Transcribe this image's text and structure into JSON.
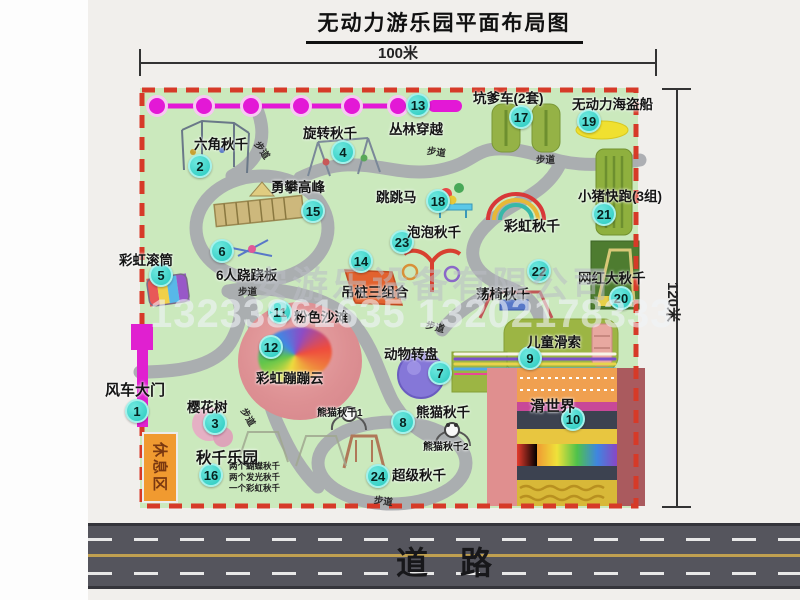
{
  "page": {
    "title": "无动力游乐园平面布局图",
    "dim_width_label": "100米",
    "dim_height_label": "120米",
    "road_label": "道路",
    "rest_area_label": "休息区"
  },
  "watermark": {
    "company": "安游乐设备有限公司",
    "phones": "13233861635 13202178333"
  },
  "colors": {
    "map_green": "#cbe9bd",
    "border_red": "#d63a28",
    "badge_teal": "#27c9be",
    "zipline_magenta": "#e318d6",
    "gate_magenta": "#e020d0",
    "rest_orange": "#f09a30",
    "path_gray": "#a9abb0",
    "road_gray": "#55555d"
  },
  "markers": [
    {
      "n": "1",
      "label": "风车大门",
      "lx": 105,
      "ly": 379,
      "bx": 137,
      "by": 411,
      "fs": 15
    },
    {
      "n": "2",
      "label": "六角秋千",
      "lx": 194,
      "ly": 133,
      "bx": 200,
      "by": 166
    },
    {
      "n": "3",
      "label": "樱花树",
      "lx": 187,
      "ly": 396,
      "bx": 215,
      "by": 423
    },
    {
      "n": "4",
      "label": "旋转秋千",
      "lx": 303,
      "ly": 122,
      "bx": 343,
      "by": 152
    },
    {
      "n": "5",
      "label": "彩虹滚筒",
      "lx": 119,
      "ly": 249,
      "bx": 161,
      "by": 275
    },
    {
      "n": "6",
      "label": "6人跷跷板",
      "lx": 216,
      "ly": 264,
      "bx": 222,
      "by": 251
    },
    {
      "n": "7",
      "label": "动物转盘",
      "lx": 384,
      "ly": 343,
      "bx": 440,
      "by": 373
    },
    {
      "n": "8",
      "label": "熊猫秋千",
      "lx": 416,
      "ly": 401,
      "bx": 403,
      "by": 422
    },
    {
      "n": "9",
      "label": "儿童滑索",
      "lx": 527,
      "ly": 331,
      "bx": 530,
      "by": 358
    },
    {
      "n": "10",
      "label": "滑世界",
      "lx": 530,
      "ly": 395,
      "bx": 573,
      "by": 419,
      "fs": 15
    },
    {
      "n": "11",
      "label": "粉色沙滩",
      "lx": 294,
      "ly": 306,
      "bx": 280,
      "by": 312
    },
    {
      "n": "12",
      "label": "彩虹蹦蹦云",
      "lx": 256,
      "ly": 367,
      "bx": 271,
      "by": 347
    },
    {
      "n": "13",
      "label": "丛林穿越",
      "lx": 389,
      "ly": 118,
      "bx": 418,
      "by": 105
    },
    {
      "n": "14",
      "label": "吊桩三组合",
      "lx": 341,
      "ly": 281,
      "bx": 361,
      "by": 261
    },
    {
      "n": "15",
      "label": "勇攀高峰",
      "lx": 271,
      "ly": 176,
      "bx": 313,
      "by": 211
    },
    {
      "n": "16",
      "label": "秋千乐园",
      "lx": 196,
      "ly": 446,
      "bx": 211,
      "by": 475,
      "fs": 15.5,
      "sub": [
        "两个蝴蝶秋千",
        "两个发光秋千",
        "一个彩虹秋千"
      ],
      "sx": 229,
      "sy": 461
    },
    {
      "n": "17",
      "label": "坑爹车(2套)",
      "lx": 473,
      "ly": 87,
      "bx": 521,
      "by": 117
    },
    {
      "n": "18",
      "label": "跳跳马",
      "lx": 376,
      "ly": 186,
      "bx": 438,
      "by": 201
    },
    {
      "n": "19",
      "label": "无动力海盗船",
      "lx": 572,
      "ly": 93,
      "bx": 589,
      "by": 121
    },
    {
      "n": "20",
      "label": "网红大秋千",
      "lx": 578,
      "ly": 267,
      "bx": 621,
      "by": 298
    },
    {
      "n": "21",
      "label": "小猪快跑(3组)",
      "lx": 578,
      "ly": 185,
      "bx": 604,
      "by": 214
    },
    {
      "n": "22",
      "label": "荡椅秋千",
      "lx": 476,
      "ly": 283,
      "bx": 539,
      "by": 271
    },
    {
      "n": "23",
      "label": "泡泡秋千",
      "lx": 407,
      "ly": 221,
      "bx": 402,
      "by": 242
    },
    {
      "n": "24",
      "label": "超级秋千",
      "lx": 392,
      "ly": 464,
      "bx": 378,
      "by": 476
    }
  ],
  "extra_labels": [
    {
      "t": "彩虹秋千",
      "x": 504,
      "y": 216,
      "fs": 14
    },
    {
      "t": "熊猫秋千1",
      "x": 317,
      "y": 404,
      "fs": 10
    },
    {
      "t": "熊猫秋千2",
      "x": 423,
      "y": 438,
      "fs": 10
    }
  ],
  "walkways": {
    "label": "步道",
    "spots": [
      {
        "x": 263,
        "y": 138,
        "r": 55
      },
      {
        "x": 428,
        "y": 143,
        "r": 8
      },
      {
        "x": 536,
        "y": 152,
        "r": 0
      },
      {
        "x": 238,
        "y": 284,
        "r": 0
      },
      {
        "x": 428,
        "y": 317,
        "r": 15
      },
      {
        "x": 250,
        "y": 405,
        "r": 60
      },
      {
        "x": 375,
        "y": 492,
        "r": 8
      }
    ]
  }
}
